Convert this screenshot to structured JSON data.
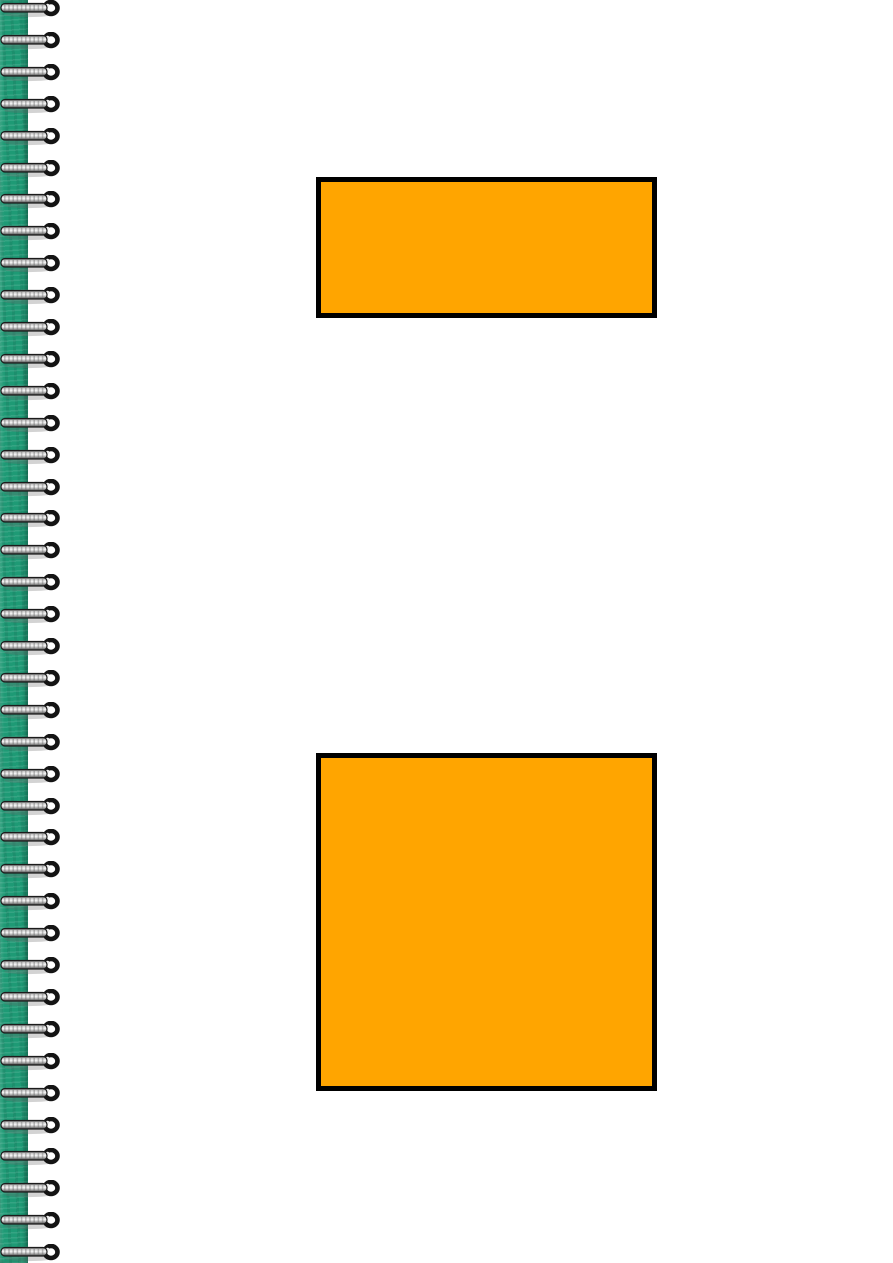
{
  "page": {
    "background_color": "#ffffff"
  },
  "binding": {
    "strip_color": "#1e9a75",
    "coil_count": 40,
    "coil_metal_light_color": "#f5f5f5",
    "coil_metal_dark_color": "#2e2e2e",
    "coil_hook_color": "#141414"
  },
  "shapes": [
    {
      "name": "orange-rectangle",
      "type": "rectangle",
      "fill": "#FFA500",
      "border_color": "#000000"
    },
    {
      "name": "orange-square",
      "type": "square",
      "fill": "#FFA500",
      "border_color": "#000000"
    }
  ]
}
